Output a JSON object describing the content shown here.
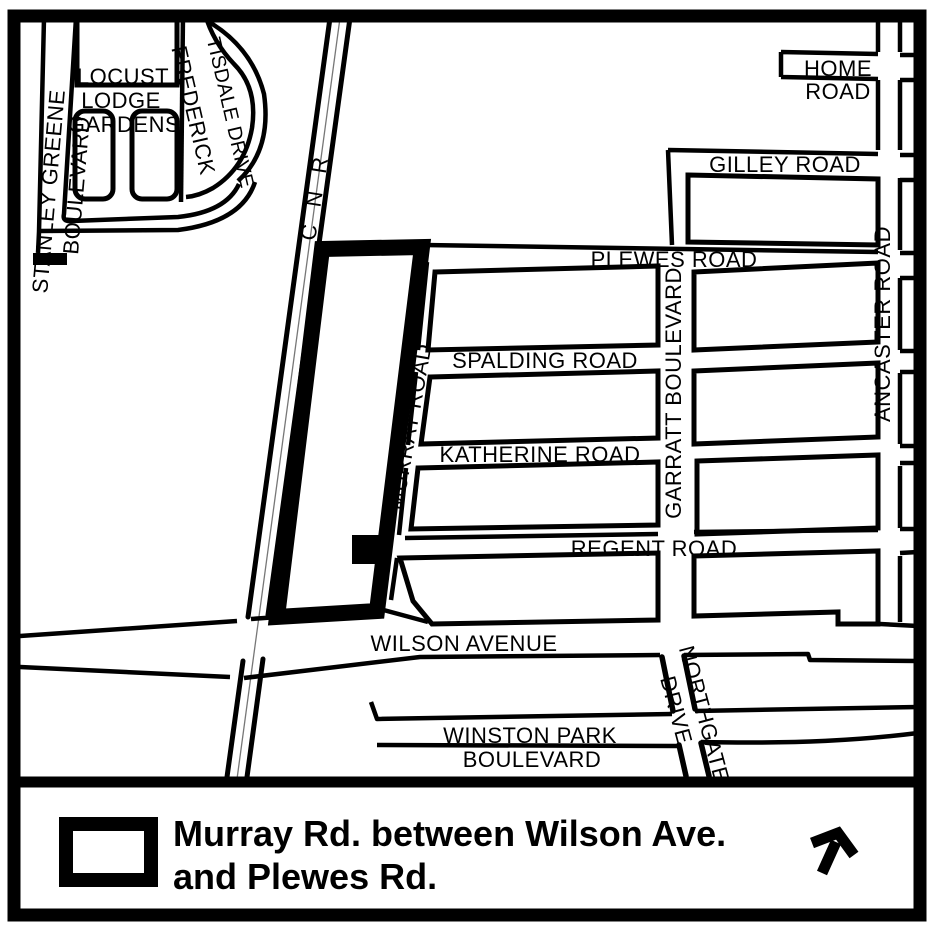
{
  "map": {
    "title": "Murray Rd. between Wilson Ave. and Plewes Rd. location map",
    "railway_label": "C N R",
    "labels": {
      "locust_line1": "LOCUST",
      "locust_line2": "LODGE",
      "locust_line3": "GARDENS",
      "stanley_line1": "STANLEY GREENE",
      "stanley_line2": "BOULEVARD",
      "frederick_line1": "FREDERICK",
      "frederick_line2": "TISDALE DRIVE",
      "home_line1": "HOME",
      "home_line2": "ROAD",
      "gilley": "GILLEY ROAD",
      "plewes": "PLEWES ROAD",
      "spalding": "SPALDING ROAD",
      "katherine": "KATHERINE ROAD",
      "regent": "REGENT ROAD",
      "garratt": "GARRATT BOULEVARD",
      "ancaster": "ANCASTER ROAD",
      "murray": "MURRAY ROAD",
      "wilson": "WILSON AVENUE",
      "northgate_line1": "NORTHGATE",
      "northgate_line2": "DRIVE",
      "winston_line1": "WINSTON PARK",
      "winston_line2": "BOULEVARD"
    }
  },
  "legend": {
    "line1": "Murray Rd. between Wilson Ave.",
    "line2": "and Plewes Rd.",
    "symbol_name": "highlighted-road-segment-symbol",
    "north_arrow_name": "north-arrow"
  },
  "colors": {
    "ink": "#000000",
    "background": "#ffffff",
    "railway_center": "#777777"
  }
}
